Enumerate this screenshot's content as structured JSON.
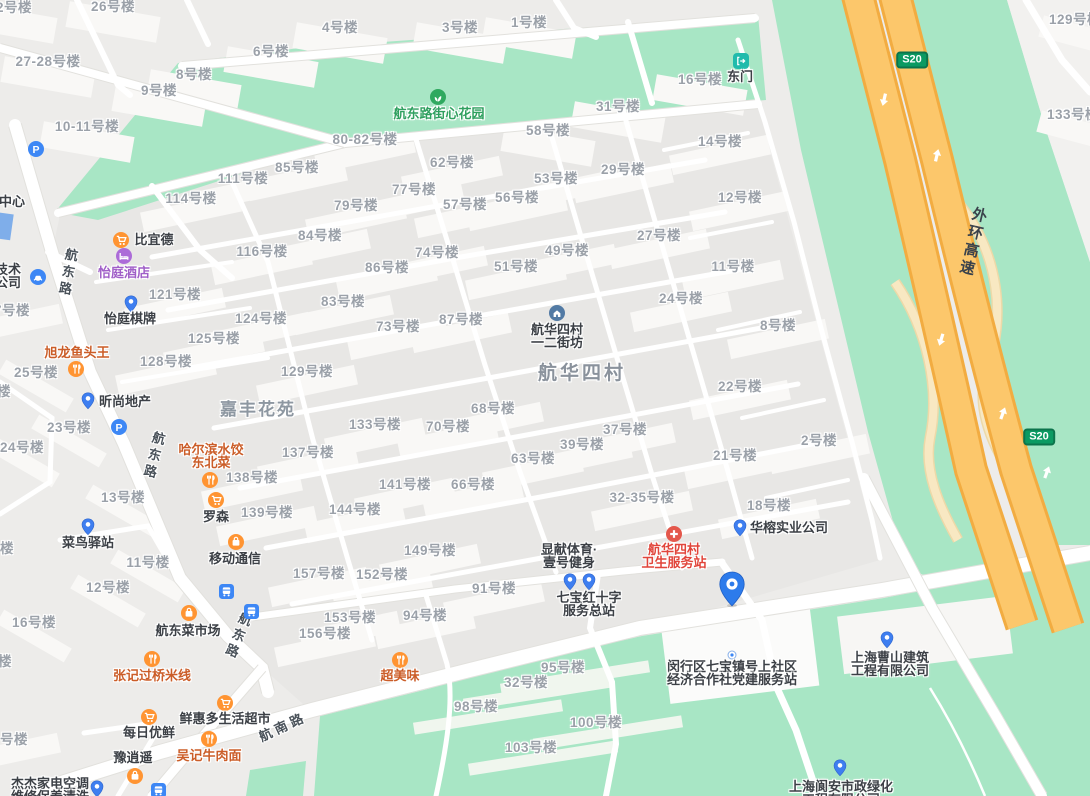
{
  "map": {
    "area_labels": [
      {
        "text": "航华四村",
        "x": 582,
        "y": 374,
        "cls": "area1"
      },
      {
        "text": "嘉丰花苑",
        "x": 258,
        "y": 410,
        "cls": "area2"
      }
    ],
    "road_labels": [
      {
        "text": "航东路",
        "x": 67,
        "y": 273,
        "rot": 10,
        "vert": true
      },
      {
        "text": "航东路",
        "x": 153,
        "y": 456,
        "rot": 14,
        "vert": true
      },
      {
        "text": "航东路",
        "x": 237,
        "y": 636,
        "rot": 22,
        "vert": true
      },
      {
        "text": "航南路",
        "x": 283,
        "y": 727,
        "rot": -25,
        "vert": false
      },
      {
        "text": "外环高速",
        "x": 972,
        "y": 242,
        "rot": 13,
        "vert": true,
        "hwy": true
      }
    ],
    "badges": [
      {
        "text": "S20",
        "x": 912,
        "y": 60
      },
      {
        "text": "S20",
        "x": 1039,
        "y": 437
      }
    ],
    "selected_marker": {
      "x": 732,
      "y": 589
    },
    "building_labels": [
      {
        "t": "42号楼",
        "x": 10,
        "y": 8
      },
      {
        "t": "26号楼",
        "x": 113,
        "y": 7
      },
      {
        "t": "27-28号楼",
        "x": 48,
        "y": 62
      },
      {
        "t": "8号楼",
        "x": 194,
        "y": 75
      },
      {
        "t": "9号楼",
        "x": 159,
        "y": 91
      },
      {
        "t": "6号楼",
        "x": 271,
        "y": 52
      },
      {
        "t": "4号楼",
        "x": 340,
        "y": 28
      },
      {
        "t": "10-11号楼",
        "x": 87,
        "y": 127
      },
      {
        "t": "3号楼",
        "x": 460,
        "y": 28
      },
      {
        "t": "1号楼",
        "x": 529,
        "y": 23
      },
      {
        "t": "16号楼",
        "x": 700,
        "y": 80
      },
      {
        "t": "31号楼",
        "x": 618,
        "y": 107
      },
      {
        "t": "58号楼",
        "x": 548,
        "y": 131
      },
      {
        "t": "14号楼",
        "x": 720,
        "y": 142
      },
      {
        "t": "12号楼",
        "x": 740,
        "y": 198
      },
      {
        "t": "29号楼",
        "x": 623,
        "y": 170
      },
      {
        "t": "53号楼",
        "x": 556,
        "y": 179
      },
      {
        "t": "56号楼",
        "x": 517,
        "y": 198
      },
      {
        "t": "57号楼",
        "x": 465,
        "y": 205
      },
      {
        "t": "62号楼",
        "x": 452,
        "y": 163
      },
      {
        "t": "77号楼",
        "x": 414,
        "y": 190
      },
      {
        "t": "79号楼",
        "x": 356,
        "y": 206
      },
      {
        "t": "80-82号楼",
        "x": 365,
        "y": 140
      },
      {
        "t": "85号楼",
        "x": 297,
        "y": 168
      },
      {
        "t": "84号楼",
        "x": 320,
        "y": 236
      },
      {
        "t": "74号楼",
        "x": 437,
        "y": 253
      },
      {
        "t": "86号楼",
        "x": 387,
        "y": 268
      },
      {
        "t": "49号楼",
        "x": 567,
        "y": 251
      },
      {
        "t": "51号楼",
        "x": 516,
        "y": 267
      },
      {
        "t": "83号楼",
        "x": 343,
        "y": 302
      },
      {
        "t": "73号楼",
        "x": 398,
        "y": 327
      },
      {
        "t": "87号楼",
        "x": 461,
        "y": 320
      },
      {
        "t": "111号楼",
        "x": 243,
        "y": 179
      },
      {
        "t": "114号楼",
        "x": 191,
        "y": 199
      },
      {
        "t": "116号楼",
        "x": 262,
        "y": 252
      },
      {
        "t": "121号楼",
        "x": 175,
        "y": 295
      },
      {
        "t": "124号楼",
        "x": 261,
        "y": 319
      },
      {
        "t": "125号楼",
        "x": 214,
        "y": 339
      },
      {
        "t": "128号楼",
        "x": 166,
        "y": 362
      },
      {
        "t": "129号楼",
        "x": 307,
        "y": 372
      },
      {
        "t": "27号楼",
        "x": 659,
        "y": 236
      },
      {
        "t": "24号楼",
        "x": 681,
        "y": 299
      },
      {
        "t": "11号楼",
        "x": 733,
        "y": 267
      },
      {
        "t": "8号楼",
        "x": 778,
        "y": 326
      },
      {
        "t": "22号楼",
        "x": 740,
        "y": 387
      },
      {
        "t": "2号楼",
        "x": 819,
        "y": 441
      },
      {
        "t": "21号楼",
        "x": 735,
        "y": 456
      },
      {
        "t": "37号楼",
        "x": 625,
        "y": 430
      },
      {
        "t": "39号楼",
        "x": 582,
        "y": 445
      },
      {
        "t": "68号楼",
        "x": 493,
        "y": 409
      },
      {
        "t": "70号楼",
        "x": 448,
        "y": 427
      },
      {
        "t": "63号楼",
        "x": 533,
        "y": 459
      },
      {
        "t": "66号楼",
        "x": 473,
        "y": 485
      },
      {
        "t": "32-35号楼",
        "x": 642,
        "y": 498
      },
      {
        "t": "18号楼",
        "x": 769,
        "y": 506
      },
      {
        "t": "133号楼",
        "x": 375,
        "y": 425
      },
      {
        "t": "137号楼",
        "x": 308,
        "y": 453
      },
      {
        "t": "138号楼",
        "x": 252,
        "y": 478
      },
      {
        "t": "139号楼",
        "x": 267,
        "y": 513
      },
      {
        "t": "141号楼",
        "x": 405,
        "y": 485
      },
      {
        "t": "144号楼",
        "x": 355,
        "y": 510
      },
      {
        "t": "149号楼",
        "x": 430,
        "y": 551
      },
      {
        "t": "157号楼",
        "x": 319,
        "y": 574
      },
      {
        "t": "152号楼",
        "x": 382,
        "y": 575
      },
      {
        "t": "153号楼",
        "x": 350,
        "y": 618
      },
      {
        "t": "156号楼",
        "x": 325,
        "y": 634
      },
      {
        "t": "91号楼",
        "x": 494,
        "y": 589
      },
      {
        "t": "94号楼",
        "x": 425,
        "y": 616
      },
      {
        "t": "95号楼",
        "x": 563,
        "y": 668,
        "g": 1
      },
      {
        "t": "32号楼",
        "x": 526,
        "y": 683,
        "g": 1
      },
      {
        "t": "98号楼",
        "x": 476,
        "y": 707,
        "g": 1
      },
      {
        "t": "100号楼",
        "x": 596,
        "y": 723,
        "g": 1
      },
      {
        "t": "103号楼",
        "x": 531,
        "y": 748,
        "g": 1
      },
      {
        "t": "25号楼",
        "x": 36,
        "y": 373
      },
      {
        "t": "23号楼",
        "x": 69,
        "y": 428
      },
      {
        "t": "24号楼",
        "x": 22,
        "y": 448
      },
      {
        "t": "13号楼",
        "x": 123,
        "y": 498
      },
      {
        "t": "11号楼",
        "x": 148,
        "y": 563
      },
      {
        "t": "12号楼",
        "x": 108,
        "y": 588
      },
      {
        "t": "16号楼",
        "x": 34,
        "y": 623
      },
      {
        "t": "6号楼",
        "x": 10,
        "y": 740
      },
      {
        "t": "7号楼",
        "x": 12,
        "y": 311
      },
      {
        "t": "楼",
        "x": 4,
        "y": 392,
        "nr": 1
      },
      {
        "t": "号楼",
        "x": 0,
        "y": 549,
        "nr": 1
      },
      {
        "t": "楼",
        "x": 5,
        "y": 662,
        "nr": 1
      },
      {
        "t": "129号楼",
        "x": 1075,
        "y": 20
      },
      {
        "t": "133号楼",
        "x": 1073,
        "y": 115
      }
    ],
    "pois": [
      {
        "id": "parking-1",
        "icon": "parking",
        "ix": 36,
        "iy": 149
      },
      {
        "id": "parking-2",
        "icon": "parking",
        "ix": 119,
        "iy": 427
      },
      {
        "id": "biyide",
        "icon": "cart",
        "ix": 121,
        "iy": 240,
        "lines": [
          "比宜德"
        ],
        "lx": 154,
        "ly": 240,
        "color": "dark"
      },
      {
        "id": "yiting-hotel",
        "icon": "hotel",
        "ix": 124,
        "iy": 256,
        "lines": [
          "怡庭酒店"
        ],
        "lx": 124,
        "ly": 273,
        "color": "purple"
      },
      {
        "id": "yiting-chess",
        "icon": "pin",
        "ix": 131,
        "iy": 304,
        "lines": [
          "怡庭棋牌"
        ],
        "lx": 130,
        "ly": 319,
        "color": "dark"
      },
      {
        "id": "xulong-fish-restaurant",
        "icon": "restaurant",
        "ix": 76,
        "iy": 369,
        "lines": [
          "旭龙鱼头王"
        ],
        "lx": 77,
        "ly": 353,
        "color": "orange"
      },
      {
        "id": "xinshang-realty",
        "icon": "pin",
        "ix": 88,
        "iy": 401,
        "lines": [
          "昕尚地产"
        ],
        "lx": 125,
        "ly": 402,
        "color": "dark"
      },
      {
        "id": "harbin-dumplings",
        "icon": "restaurant",
        "ix": 210,
        "iy": 480,
        "lines": [
          "哈尔滨水饺",
          "东北菜"
        ],
        "lx": 211,
        "ly": 450,
        "color": "orange"
      },
      {
        "id": "lawson",
        "icon": "cart",
        "ix": 216,
        "iy": 500,
        "lines": [
          "罗森"
        ],
        "lx": 216,
        "ly": 517,
        "color": "dark"
      },
      {
        "id": "mobile-store",
        "icon": "bag",
        "ix": 236,
        "iy": 542,
        "lines": [
          "移动通信"
        ],
        "lx": 235,
        "ly": 559,
        "color": "dark"
      },
      {
        "id": "cainiao-station",
        "icon": "pin",
        "ix": 88,
        "iy": 527,
        "lines": [
          "菜鸟驿站"
        ],
        "lx": 88,
        "ly": 543,
        "color": "dark"
      },
      {
        "id": "hangdong-market",
        "icon": "bag",
        "ix": 189,
        "iy": 613,
        "lines": [
          "航东菜市场"
        ],
        "lx": 188,
        "ly": 631,
        "color": "dark"
      },
      {
        "id": "zhangji-rice-noodles",
        "icon": "restaurant",
        "ix": 152,
        "iy": 659,
        "lines": [
          "张记过桥米线"
        ],
        "lx": 152,
        "ly": 676,
        "color": "orange"
      },
      {
        "id": "meiri-youxian",
        "icon": "cart",
        "ix": 149,
        "iy": 717,
        "lines": [
          "每日优鲜"
        ],
        "lx": 149,
        "ly": 733,
        "color": "dark"
      },
      {
        "id": "xianhuiduo-market",
        "icon": "cart",
        "ix": 225,
        "iy": 703,
        "lines": [
          "鲜惠多生活超市"
        ],
        "lx": 225,
        "ly": 719,
        "color": "dark"
      },
      {
        "id": "wuji-beef-noodles",
        "icon": "restaurant",
        "ix": 209,
        "iy": 739,
        "lines": [
          "吴记牛肉面"
        ],
        "lx": 209,
        "ly": 756,
        "color": "orange"
      },
      {
        "id": "yuxiaoyao",
        "icon": "bag",
        "ix": 135,
        "iy": 776,
        "lines": [
          "豫逍遥"
        ],
        "lx": 133,
        "ly": 758,
        "color": "dark"
      },
      {
        "id": "jiejie-appliance",
        "icon": "pin",
        "ix": 97,
        "iy": 789,
        "lines": [
          "杰杰家电空调",
          "维修保养清洗"
        ],
        "lx": 50,
        "ly": 784,
        "color": "dark"
      },
      {
        "id": "chaomeiwei",
        "icon": "restaurant",
        "ix": 400,
        "iy": 660,
        "lines": [
          "超美味"
        ],
        "lx": 400,
        "ly": 676,
        "color": "orange"
      },
      {
        "id": "xianxian-gym",
        "lines": [
          "显献体育·",
          "壹号健身"
        ],
        "lx": 569,
        "ly": 550,
        "color": "dark"
      },
      {
        "id": "qibao-redcross-station",
        "icon": "pin",
        "ix": 570,
        "iy": 582,
        "icon2": "pin",
        "i2x": 589,
        "i2y": 582,
        "lines": [
          "七宝红十字",
          "服务总站"
        ],
        "lx": 589,
        "ly": 598,
        "color": "dark"
      },
      {
        "id": "hanghua-health-station",
        "icon": "redcross",
        "ix": 674,
        "iy": 534,
        "lines": [
          "航华四村",
          "卫生服务站"
        ],
        "lx": 674,
        "ly": 550,
        "color": "red"
      },
      {
        "id": "huarong-industry",
        "icon": "pin",
        "ix": 740,
        "iy": 528,
        "lines": [
          "华榕实业公司"
        ],
        "lx": 789,
        "ly": 528,
        "color": "dark"
      },
      {
        "id": "minhang-party-station",
        "icon": "dot",
        "ix": 732,
        "iy": 652,
        "lines": [
          "闵行区七宝镇号上社区",
          "经济合作社党建服务站"
        ],
        "lx": 732,
        "ly": 667,
        "color": "dark"
      },
      {
        "id": "caoshan-construction",
        "icon": "pin",
        "ix": 887,
        "iy": 640,
        "lines": [
          "上海曹山建筑",
          "工程有限公司"
        ],
        "lx": 890,
        "ly": 658,
        "color": "dark"
      },
      {
        "id": "langan-greening",
        "icon": "pin",
        "ix": 840,
        "iy": 768,
        "lines": [
          "上海阆安市政绿化",
          "工程有限公司"
        ],
        "lx": 841,
        "ly": 787,
        "color": "dark"
      },
      {
        "id": "jiexin-park",
        "icon": "park",
        "ix": 438,
        "iy": 97,
        "lines": [
          "航东路街心花园"
        ],
        "lx": 439,
        "ly": 114,
        "color": "green"
      },
      {
        "id": "east-gate",
        "icon": "gate",
        "ix": 741,
        "iy": 61,
        "lines": [
          "东门"
        ],
        "lx": 740,
        "ly": 77,
        "color": "dark"
      },
      {
        "id": "hanghua-jiefang",
        "icon": "community",
        "ix": 557,
        "iy": 313,
        "lines": [
          "航华四村",
          "一二街坊"
        ],
        "lx": 557,
        "ly": 330,
        "color": "dark"
      },
      {
        "id": "tech-company-partial",
        "icon": "car",
        "ix": 38,
        "iy": 277,
        "lines": [
          "技术",
          "公司"
        ],
        "lx": 8,
        "ly": 270,
        "color": "dark"
      },
      {
        "id": "center-partial",
        "lines": [
          "中心"
        ],
        "lx": 12,
        "ly": 202,
        "color": "dark"
      },
      {
        "id": "bus-stop-1",
        "icon": "bus",
        "ix": 226,
        "iy": 591
      },
      {
        "id": "bus-stop-2",
        "icon": "bus",
        "ix": 251,
        "iy": 611
      },
      {
        "id": "bus-stop-3",
        "icon": "bus",
        "ix": 158,
        "iy": 790
      }
    ],
    "colors": {
      "base": "#edecea",
      "block": "#e8e7e5",
      "green": "#a8e6c5",
      "building": "#f9f8f6",
      "road": "#ffffff",
      "highway_fill": "#fcc76b",
      "highway_edge": "#f2ac41",
      "badge_green": "#0b9a62",
      "poi_blue": "#3d87f5",
      "poi_orange": "#ff9432",
      "marker_blue": "#2d7beb"
    }
  }
}
